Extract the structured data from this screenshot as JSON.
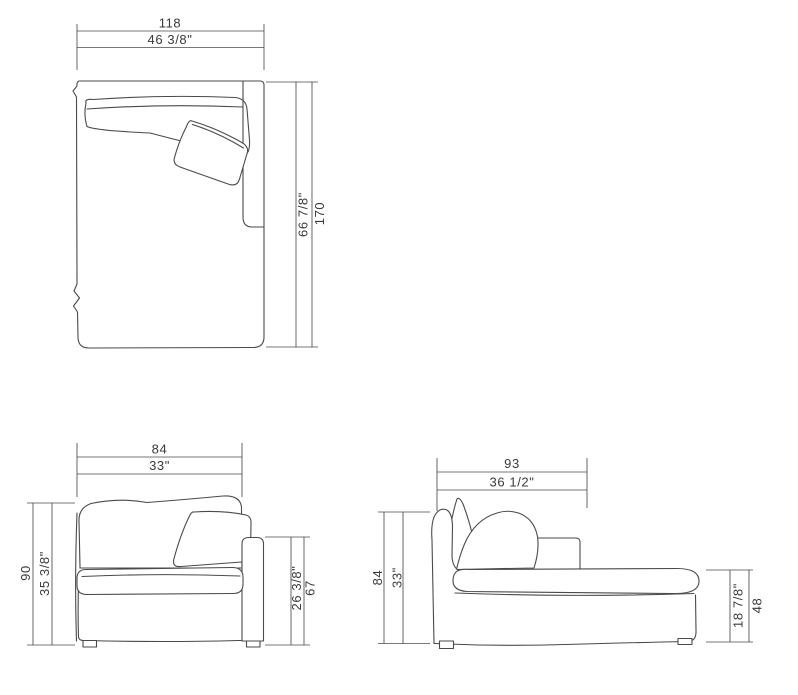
{
  "style": {
    "line_color": "#4a4a4a",
    "text_color": "#3a3a3a",
    "background": "#ffffff"
  },
  "views": {
    "top": {
      "label": "top view",
      "width_cm": "118",
      "width_in": "46 3/8\"",
      "depth_in": "66 7/8\"",
      "depth_cm": "170"
    },
    "front": {
      "label": "front view",
      "width_cm": "84",
      "width_in": "33\"",
      "height_cm": "90",
      "height_in": "35 3/8\"",
      "arm_height_in": "26 3/8\"",
      "arm_height_cm": "67"
    },
    "side": {
      "label": "side view",
      "depth_cm": "93",
      "depth_in": "36 1/2\"",
      "height_cm": "84",
      "height_in": "33\"",
      "seat_height_in": "18 7/8\"",
      "seat_height_cm": "48"
    }
  }
}
